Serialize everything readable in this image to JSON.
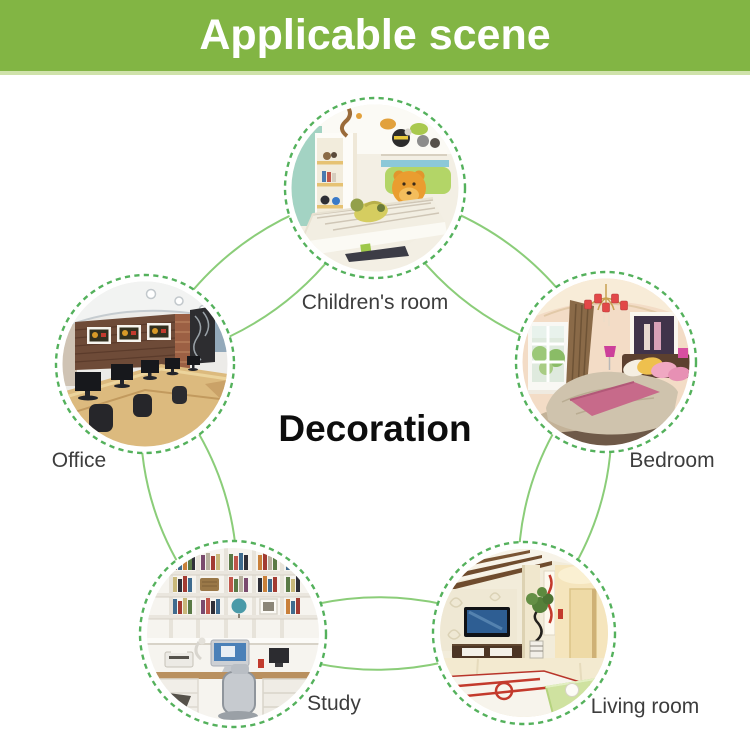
{
  "banner": {
    "title": "Applicable scene"
  },
  "center_label": "Decoration",
  "scenes": [
    {
      "id": "children-room",
      "label": "Children's room"
    },
    {
      "id": "office",
      "label": "Office"
    },
    {
      "id": "bedroom",
      "label": "Bedroom"
    },
    {
      "id": "study",
      "label": "Study"
    },
    {
      "id": "living-room",
      "label": "Living room"
    }
  ],
  "colors": {
    "banner_bg": "#82b544",
    "banner_edge": "#cfe2aa",
    "banner_text": "#ffffff",
    "dashed_ring": "#54b15c",
    "connector_line": "#8bcd79",
    "label_text": "#3d3d3d",
    "center_text": "#0d0d0d",
    "background": "#ffffff"
  }
}
